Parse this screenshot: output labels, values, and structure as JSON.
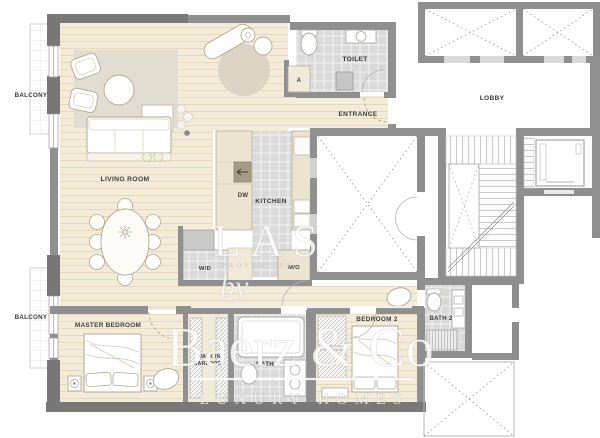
{
  "title": "Apartment floor plan",
  "labels": {
    "balcony_top": "BALCONY",
    "balcony_bottom": "BALCONY",
    "living_room": "LIVING ROOM",
    "dw": "DW",
    "kitchen": "KITCHEN",
    "toilet": "TOILET",
    "closet_a": "A",
    "entrance": "ENTRANCE",
    "lobby": "LOBBY",
    "wd": "W/D",
    "mo": "M/O",
    "master_bedroom": "MASTER BEDROOM",
    "walk_in_1": "WALK IN",
    "walk_in_2": "WARDROBE",
    "bath1": "BATH 1",
    "bedroom2": "BEDROOM 2",
    "bath2": "BATH 2"
  },
  "watermark": {
    "brand_top": "LAS",
    "brand_top_sub": "PROPERTIES",
    "prefix": "by",
    "brand": "Baerz & Co",
    "tagline": "LUXURY HOMES"
  },
  "colors": {
    "wall": "#8f8f8f",
    "wall_dark": "#787878",
    "wood": "#f4ecd9",
    "wood_line": "#e4d9bf",
    "tile": "#d9d9d9",
    "rug": "#e2ddd1",
    "counter": "#ece4d0",
    "label_text": "#3b3b3b",
    "watermark": "#ffffff"
  }
}
